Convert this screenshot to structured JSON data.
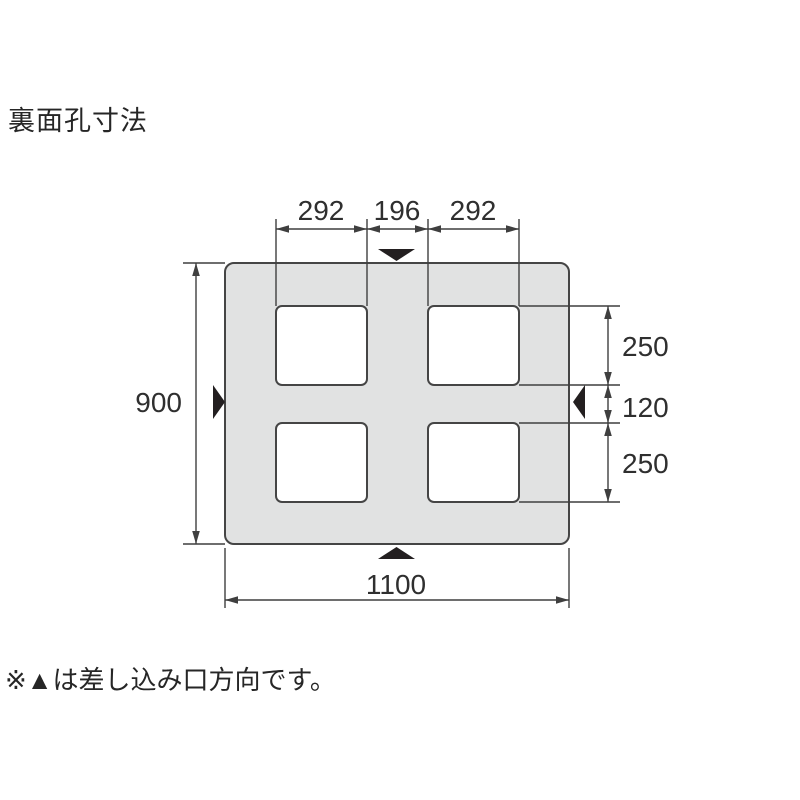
{
  "title": "裏面孔寸法",
  "note": "※▲は差し込み口方向です。",
  "colors": {
    "background": "#ffffff",
    "pallet_fill": "#e1e2e2",
    "hole_fill": "#ffffff",
    "line": "#3f3f3f",
    "text": "#2f2f2f",
    "marker": "#231f20"
  },
  "diagram": {
    "dimensions": {
      "top_widths": [
        "292",
        "196",
        "292"
      ],
      "left_height": "900",
      "right_heights": [
        "250",
        "120",
        "250"
      ],
      "bottom_width": "1100"
    },
    "insertion_markers": [
      {
        "position": "top",
        "direction": "down"
      },
      {
        "position": "left",
        "direction": "right"
      },
      {
        "position": "right",
        "direction": "left"
      },
      {
        "position": "bottom",
        "direction": "up"
      }
    ]
  }
}
